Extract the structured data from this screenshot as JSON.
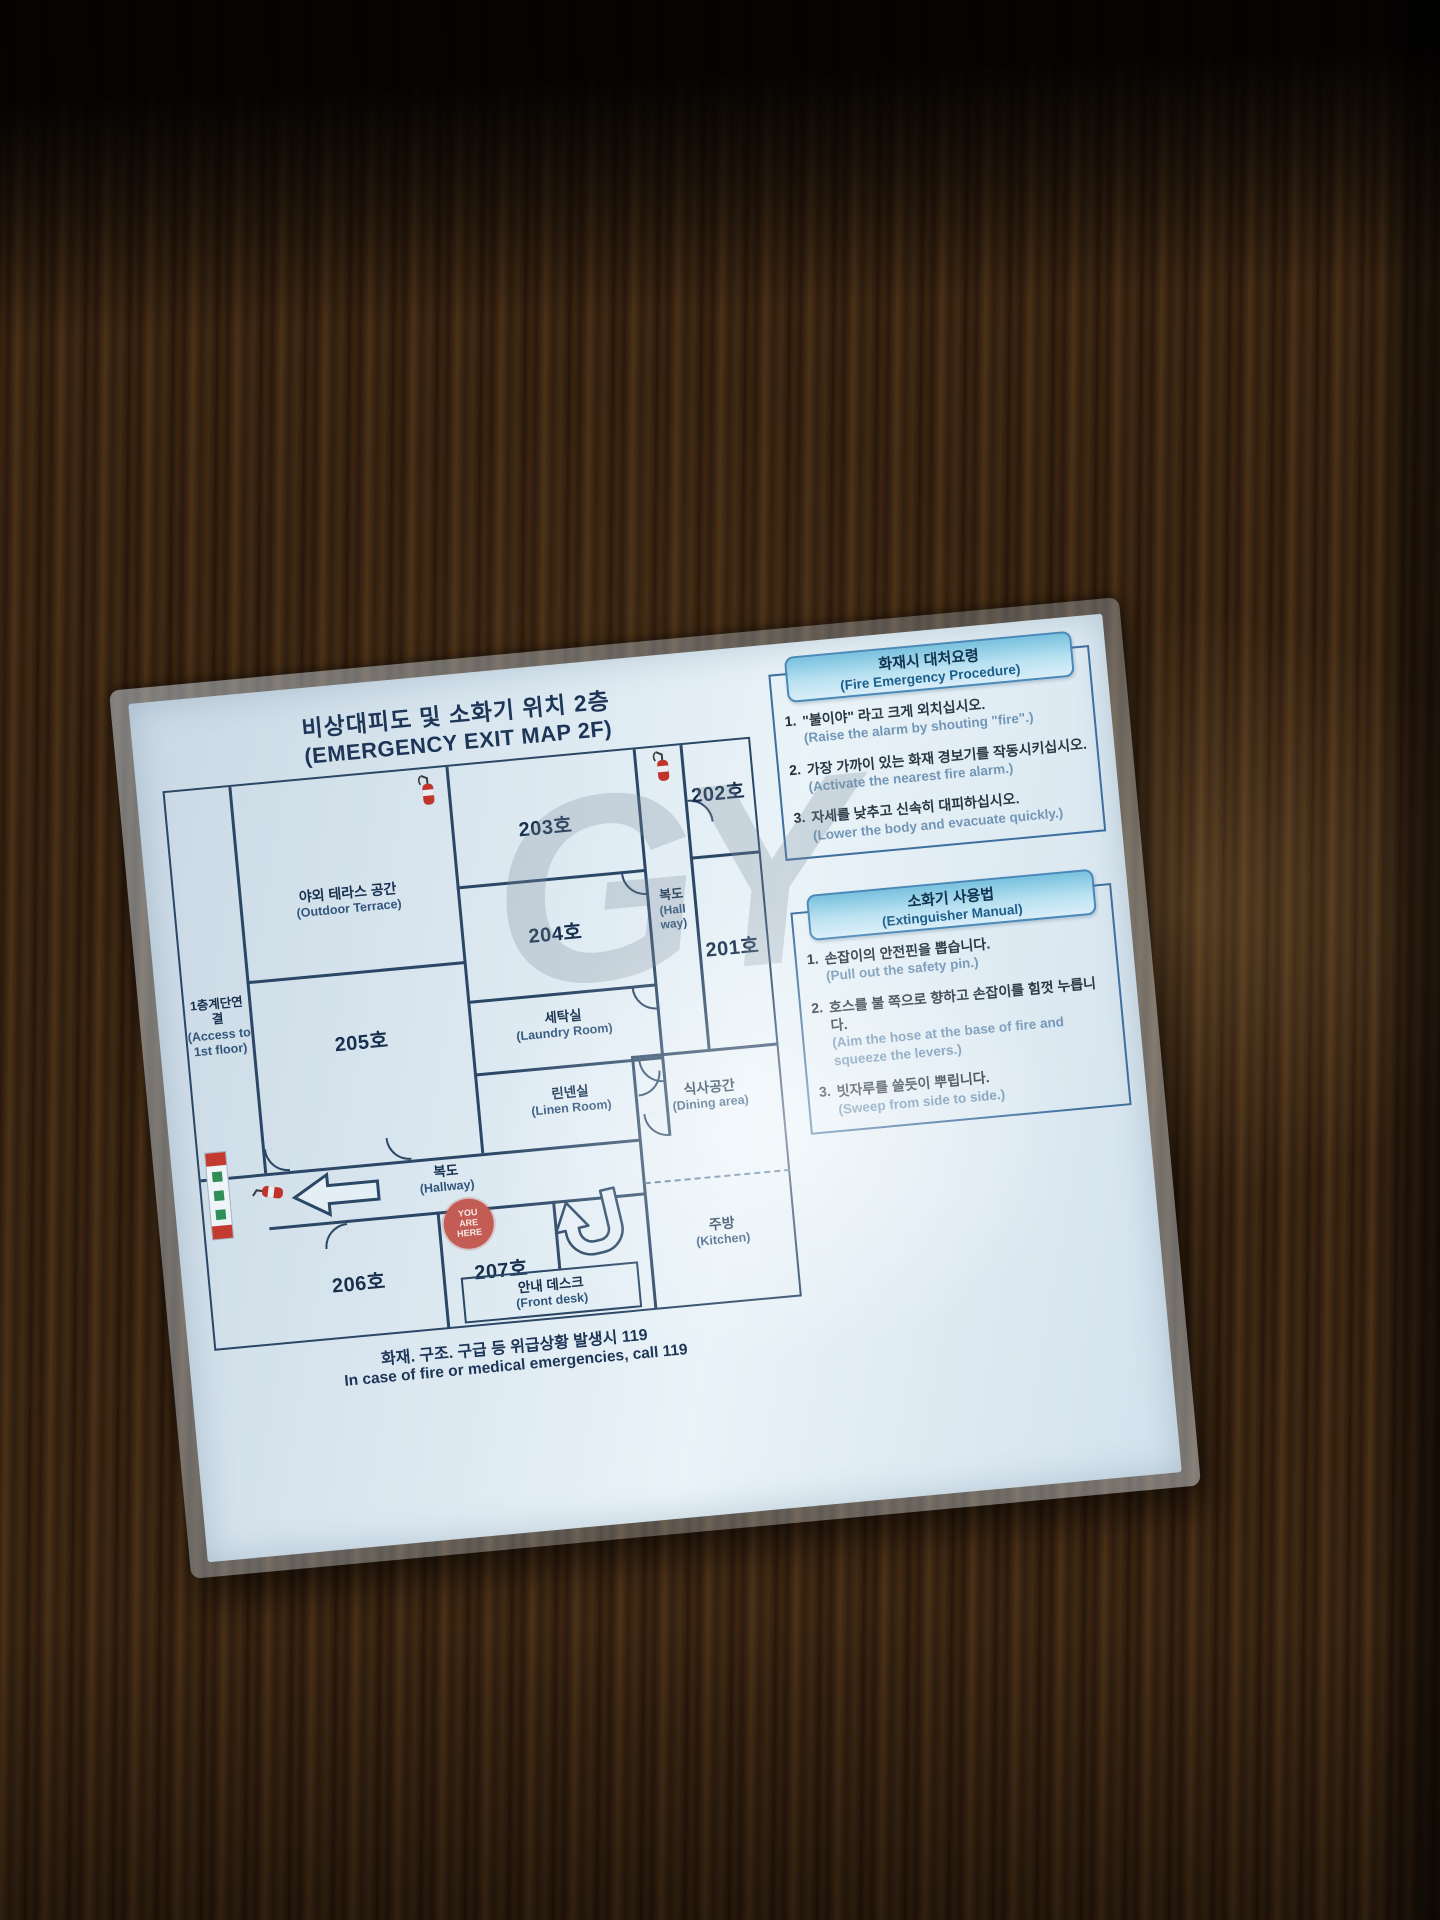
{
  "sign": {
    "title_ko": "비상대피도 및 소화기 위치 2층",
    "title_en": "(EMERGENCY EXIT MAP 2F)",
    "footer_ko": "화재. 구조. 구급 등 위급상황 발생시 119",
    "footer_en": "In case of fire or medical emergencies, call 119",
    "watermark": "GY"
  },
  "floor_plan": {
    "access_ko": "1층계단연결",
    "access_en1": "(Access to",
    "access_en2": "1st floor)",
    "terrace_ko": "야외 테라스 공간",
    "terrace_en": "(Outdoor Terrace)",
    "room203": "203호",
    "room202": "202호",
    "room204": "204호",
    "room201": "201호",
    "hall_v_ko": "복도",
    "hall_v_en1": "(Hall",
    "hall_v_en2": "way)",
    "laundry_ko": "세탁실",
    "laundry_en": "(Laundry Room)",
    "linen_ko": "린넨실",
    "linen_en": "(Linen Room)",
    "room205": "205호",
    "hallway_ko": "복도",
    "hallway_en": "(Hallway)",
    "dining_ko": "식사공간",
    "dining_en": "(Dining area)",
    "room206": "206호",
    "room207": "207호",
    "kitchen_ko": "주방",
    "kitchen_en": "(Kitchen)",
    "front_desk_ko": "안내 데스크",
    "front_desk_en": "(Front desk)",
    "you_are_here": [
      "YOU",
      "ARE",
      "HERE"
    ]
  },
  "fire_procedure": {
    "title_ko": "화재시 대처요령",
    "title_en": "(Fire Emergency Procedure)",
    "items": [
      {
        "num": "1.",
        "ko": "\"불이야\" 라고 크게 외치십시오.",
        "en": "(Raise the alarm by shouting \"fire\".)"
      },
      {
        "num": "2.",
        "ko": "가장 가까이 있는 화재 경보기를 작동시키십시오.",
        "en": "(Activate the nearest fire alarm.)"
      },
      {
        "num": "3.",
        "ko": "자세를 낮추고 신속히 대피하십시오.",
        "en": "(Lower the body and evacuate quickly.)"
      }
    ]
  },
  "extinguisher_manual": {
    "title_ko": "소화기 사용법",
    "title_en": "(Extinguisher Manual)",
    "items": [
      {
        "num": "1.",
        "ko": "손잡이의 안전핀을 뽑습니다.",
        "en": "(Pull out the safety pin.)"
      },
      {
        "num": "2.",
        "ko": "호스를 불 쪽으로 향하고 손잡이를 힘껏 누릅니다.",
        "en": "(Aim the hose at the base of fire and squeeze the levers.)"
      },
      {
        "num": "3.",
        "ko": "빗자루를 쓸듯이 뿌립니다.",
        "en": "(Sweep from side to side.)"
      }
    ]
  },
  "colors": {
    "paper": "#dce8f1",
    "wall_line": "#2b4766",
    "header_blue": "#79c2de",
    "accent_red": "#c0342b",
    "text_navy": "#1d3557",
    "text_en_blue": "#7396b6"
  }
}
